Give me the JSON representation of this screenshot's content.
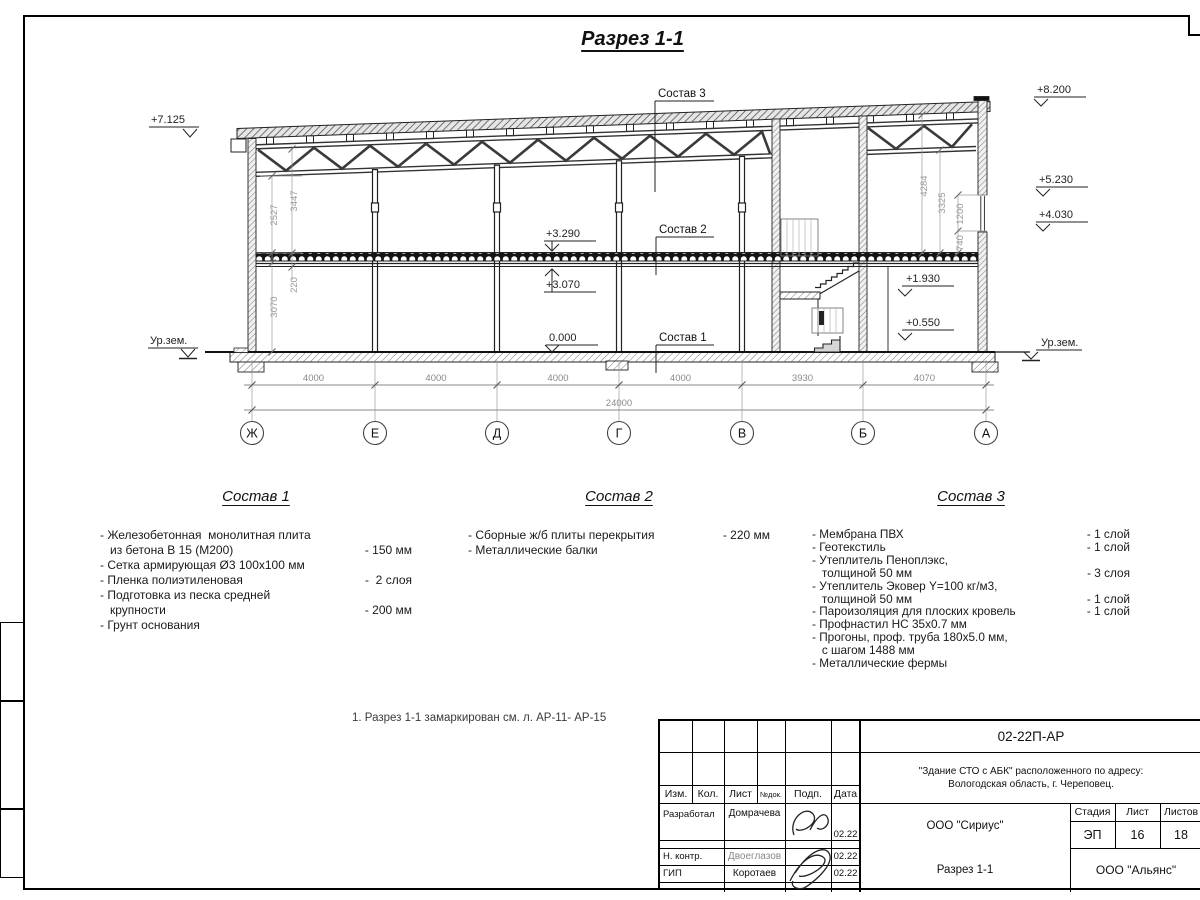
{
  "sheet": {
    "title": "Разрез 1-1",
    "note": "1. Разрез 1-1 замаркирован см. л. АР-11- АР-15"
  },
  "section": {
    "callouts": [
      "Состав 3",
      "Состав 2",
      "Состав 1"
    ],
    "elevations": {
      "left_top": "+7.125",
      "ground": "Ур.зем.",
      "right_top": "+8.200",
      "right_mid1": "+5.230",
      "right_mid2": "+4.030",
      "floor2_top": "+3.290",
      "floor2_bottom": "+3.070",
      "zero": "0.000",
      "mezz_upper": "+1.930",
      "mezz_lower": "+0.550"
    },
    "vdims": {
      "left": [
        "2527",
        "3447",
        "220",
        "3070"
      ],
      "right": [
        "4284",
        "3325",
        "1200",
        "740"
      ]
    },
    "bottom_dims": [
      "4000",
      "4000",
      "4000",
      "4000",
      "3930",
      "4070"
    ],
    "total_dim": "24000",
    "axes": [
      "Ж",
      "Е",
      "Д",
      "Г",
      "В",
      "Б",
      "А"
    ]
  },
  "compositions": [
    {
      "title": "Состав 1",
      "lines": [
        {
          "t": "- Железобетонная  монолитная плита",
          "v": ""
        },
        {
          "t": "   из бетона В 15 (М200)",
          "v": "- 150 мм"
        },
        {
          "t": "- Сетка армирующая Ø3 100х100 мм",
          "v": ""
        },
        {
          "t": "- Пленка полиэтиленовая",
          "v": "-  2 слоя"
        },
        {
          "t": "- Подготовка из песка средней",
          "v": ""
        },
        {
          "t": "   крупности",
          "v": "- 200 мм"
        },
        {
          "t": "- Грунт основания",
          "v": ""
        }
      ]
    },
    {
      "title": "Состав 2",
      "lines": [
        {
          "t": "- Сборные ж/б плиты перекрытия",
          "v": "- 220 мм"
        },
        {
          "t": "- Металлические балки",
          "v": ""
        }
      ]
    },
    {
      "title": "Состав 3",
      "lines": [
        {
          "t": "- Мембрана ПВХ",
          "v": "- 1 слой"
        },
        {
          "t": "- Геотекстиль",
          "v": "- 1 слой"
        },
        {
          "t": "- Утеплитель Пеноплэкс,",
          "v": ""
        },
        {
          "t": "   толщиной 50 мм",
          "v": "- 3 слоя"
        },
        {
          "t": "- Утеплитель Эковер Y=100 кг/м3,",
          "v": ""
        },
        {
          "t": "   толщиной 50 мм",
          "v": "- 1 слой"
        },
        {
          "t": "- Пароизоляция для плоских кровель",
          "v": "- 1 слой"
        },
        {
          "t": "- Профнастил НС 35х0.7 мм",
          "v": ""
        },
        {
          "t": "- Прогоны, проф. труба 180х5.0 мм,",
          "v": ""
        },
        {
          "t": "   с шагом 1488 мм",
          "v": ""
        },
        {
          "t": "- Металлические фермы",
          "v": ""
        }
      ]
    }
  ],
  "titleblock": {
    "doc_code": "02-22П-АР",
    "project_line1": "\"Здание СТО с АБК\" расположенного по адресу:",
    "project_line2": "Вологодская область, г. Череповец.",
    "designer_org": "ООО \"Сириус\"",
    "contractor_org": "ООО \"Альянс\"",
    "drawing_title": "Разрез 1-1",
    "stage_label": "Стадия",
    "stage": "ЭП",
    "sheet_label": "Лист",
    "sheet": "16",
    "sheets_label": "Листов",
    "sheets": "18",
    "col_headers": [
      "Изм.",
      "Кол.",
      "Лист",
      "№док.",
      "Подп.",
      "Дата"
    ],
    "rows": [
      {
        "role": "Разработал",
        "name": "Домрачева",
        "date": "02.22"
      },
      {
        "role": "Н. контр.",
        "name": "Двоеглазов",
        "date": "02.22"
      },
      {
        "role": "ГИП",
        "name": "Коротаев",
        "date": "02.22"
      }
    ]
  }
}
